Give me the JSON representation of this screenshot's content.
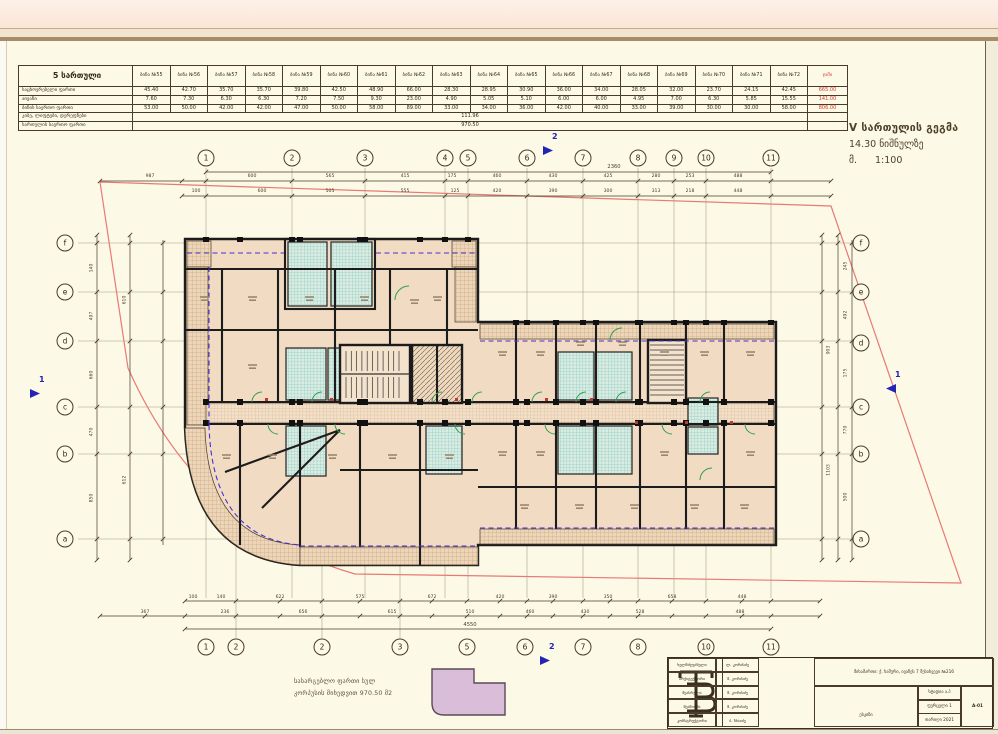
{
  "area_table": {
    "title": "5 სართული",
    "columns": [
      "ბინა №55",
      "ბინა №56",
      "ბინა №57",
      "ბინა №58",
      "ბინა №59",
      "ბინა №60",
      "ბინა №61",
      "ბინა №62",
      "ბინა №63",
      "ბინა №64",
      "ბინა №65",
      "ბინა №66",
      "ბინა №67",
      "ბინა №68",
      "ბინა №69",
      "ბინა №70",
      "ბინა №71",
      "ბინა №72"
    ],
    "total_header": "ჯამი",
    "rows": [
      {
        "label": "საცხოვრებელი ფართი",
        "values": [
          "45.40",
          "42.70",
          "35.70",
          "35.70",
          "39.80",
          "42.50",
          "48.90",
          "66.00",
          "28.30",
          "28.95",
          "30.90",
          "36.00",
          "34.00",
          "28.05",
          "32.00",
          "23.70",
          "24.15",
          "42.45"
        ],
        "total": "665.00"
      },
      {
        "label": "აივანი",
        "values": [
          "7.60",
          "7.30",
          "6.30",
          "6.30",
          "7.20",
          "7.50",
          "9.30",
          "23.00",
          "4.90",
          "5.05",
          "5.10",
          "6.00",
          "6.00",
          "4.95",
          "7.00",
          "6.30",
          "5.85",
          "15.55"
        ],
        "total": "141.00"
      },
      {
        "label": "ბინის საერთო ფართი",
        "values": [
          "53.00",
          "50.00",
          "42.00",
          "42.00",
          "47.00",
          "50.00",
          "58.00",
          "89.00",
          "33.00",
          "34.00",
          "36.00",
          "42.00",
          "40.00",
          "33.00",
          "39.00",
          "30.00",
          "30.00",
          "58.00"
        ],
        "total": "806.00"
      },
      {
        "label": "კიბე, ლიფტები, დერეფნები",
        "span_value": "111.96"
      },
      {
        "label": "სართულის საერთო ფართი",
        "span_value": "970.50"
      }
    ]
  },
  "drawing_title": {
    "line1": "V სართულის გეგმა",
    "line2": "14.30 ნიშნულზე",
    "scale_prefix": "მ.",
    "scale_value": "1:100"
  },
  "legend": {
    "line1": "სასარგებლო ფართი სულ",
    "line2": "კორპუსის მიხედვით 970.50 მ2"
  },
  "grid": {
    "top": [
      {
        "n": "1",
        "x": 206
      },
      {
        "n": "2",
        "x": 292
      },
      {
        "n": "3",
        "x": 365
      },
      {
        "n": "4",
        "x": 445
      },
      {
        "n": "5",
        "x": 468
      },
      {
        "n": "6",
        "x": 527
      },
      {
        "n": "7",
        "x": 583
      },
      {
        "n": "8",
        "x": 638
      },
      {
        "n": "9",
        "x": 674
      },
      {
        "n": "10",
        "x": 706
      },
      {
        "n": "11",
        "x": 771
      }
    ],
    "bottom": [
      {
        "n": "1",
        "x": 206
      },
      {
        "n": "2",
        "x": 236
      },
      {
        "n": "2",
        "x": 322
      },
      {
        "n": "3",
        "x": 400
      },
      {
        "n": "5",
        "x": 467
      },
      {
        "n": "6",
        "x": 525
      },
      {
        "n": "7",
        "x": 583
      },
      {
        "n": "8",
        "x": 638
      },
      {
        "n": "10",
        "x": 706
      },
      {
        "n": "11",
        "x": 771
      }
    ],
    "left": [
      {
        "n": "f",
        "y": 243
      },
      {
        "n": "e",
        "y": 292
      },
      {
        "n": "d",
        "y": 341
      },
      {
        "n": "c",
        "y": 407
      },
      {
        "n": "b",
        "y": 454
      },
      {
        "n": "a",
        "y": 539
      }
    ],
    "right": [
      {
        "n": "f",
        "y": 243
      },
      {
        "n": "e",
        "y": 292
      },
      {
        "n": "d",
        "y": 343
      },
      {
        "n": "c",
        "y": 407
      },
      {
        "n": "b",
        "y": 454
      },
      {
        "n": "a",
        "y": 539
      }
    ]
  },
  "section_markers": [
    {
      "label": "1",
      "x": 30,
      "y": 389,
      "dir": "right"
    },
    {
      "label": "1",
      "x": 886,
      "y": 384,
      "dir": "left"
    },
    {
      "label": "2",
      "x": 543,
      "y": 146,
      "dir": "right"
    },
    {
      "label": "2",
      "x": 540,
      "y": 656,
      "dir": "right"
    }
  ],
  "dimensions": {
    "top_overall": {
      "x": 614,
      "y": 170,
      "v": "2360"
    },
    "top_row1_y": 179,
    "top_row1": [
      {
        "x": 150,
        "v": "987"
      },
      {
        "x": 252,
        "v": "600"
      },
      {
        "x": 330,
        "v": "565"
      },
      {
        "x": 405,
        "v": "415"
      },
      {
        "x": 452,
        "v": "175"
      },
      {
        "x": 497,
        "v": "460"
      },
      {
        "x": 553,
        "v": "430"
      },
      {
        "x": 608,
        "v": "425"
      },
      {
        "x": 656,
        "v": "280"
      },
      {
        "x": 690,
        "v": "253"
      },
      {
        "x": 738,
        "v": "488"
      }
    ],
    "top_row2_y": 194,
    "top_row2": [
      {
        "x": 196,
        "v": "100"
      },
      {
        "x": 262,
        "v": "600"
      },
      {
        "x": 330,
        "v": "505"
      },
      {
        "x": 405,
        "v": "555"
      },
      {
        "x": 455,
        "v": "125"
      },
      {
        "x": 497,
        "v": "420"
      },
      {
        "x": 553,
        "v": "390"
      },
      {
        "x": 608,
        "v": "300"
      },
      {
        "x": 656,
        "v": "313"
      },
      {
        "x": 690,
        "v": "218"
      },
      {
        "x": 738,
        "v": "448"
      }
    ],
    "bottom_row1_y": 600,
    "bottom_row1": [
      {
        "x": 193,
        "v": "100"
      },
      {
        "x": 221,
        "v": "140"
      },
      {
        "x": 280,
        "v": "622"
      },
      {
        "x": 360,
        "v": "575"
      },
      {
        "x": 432,
        "v": "672"
      },
      {
        "x": 500,
        "v": "420"
      },
      {
        "x": 553,
        "v": "390"
      },
      {
        "x": 608,
        "v": "350"
      },
      {
        "x": 672,
        "v": "658"
      },
      {
        "x": 742,
        "v": "448"
      }
    ],
    "bottom_row2_y": 615,
    "bottom_row2": [
      {
        "x": 145,
        "v": "367"
      },
      {
        "x": 225,
        "v": "236"
      },
      {
        "x": 303,
        "v": "656"
      },
      {
        "x": 392,
        "v": "615"
      },
      {
        "x": 470,
        "v": "510"
      },
      {
        "x": 530,
        "v": "460"
      },
      {
        "x": 585,
        "v": "430"
      },
      {
        "x": 640,
        "v": "528"
      },
      {
        "x": 740,
        "v": "488"
      }
    ],
    "bottom_overall": {
      "x": 470,
      "y": 628,
      "v": "4550"
    },
    "left": [
      {
        "x": 92,
        "y": 268,
        "v": "140"
      },
      {
        "x": 92,
        "y": 316,
        "v": "497"
      },
      {
        "x": 92,
        "y": 375,
        "v": "660"
      },
      {
        "x": 92,
        "y": 432,
        "v": "470"
      },
      {
        "x": 92,
        "y": 498,
        "v": "850"
      },
      {
        "x": 125,
        "y": 300,
        "v": "610"
      },
      {
        "x": 125,
        "y": 480,
        "v": "612"
      }
    ],
    "right": [
      {
        "x": 846,
        "y": 266,
        "v": "245"
      },
      {
        "x": 846,
        "y": 315,
        "v": "492"
      },
      {
        "x": 846,
        "y": 373,
        "v": "175"
      },
      {
        "x": 846,
        "y": 430,
        "v": "770"
      },
      {
        "x": 846,
        "y": 497,
        "v": "500"
      },
      {
        "x": 829,
        "y": 350,
        "v": "903"
      },
      {
        "x": 829,
        "y": 470,
        "v": "1103"
      }
    ]
  },
  "title_block": {
    "logo": "TB",
    "entries": [
      {
        "role": "ხელმძღვანელი",
        "name": "ლ. კორძაძე"
      },
      {
        "role": "არქიტექტორი",
        "name": "მ. კორძაძე"
      },
      {
        "role": "შეასრულა",
        "name": "მ. კორძაძე"
      },
      {
        "role": "შეამოწმა",
        "name": "მ. კორძაძე"
      },
      {
        "role": "კონსტრუქტორი",
        "name": "ბ. ჩხაიძე"
      }
    ],
    "project": "მისამართი: ქ. ხაშური, ივანეს 7 შესახვევი №216",
    "drawing_name": "ესკიზი",
    "stage_label": "სტადია ა.პ",
    "sheet_label": "ფურცელი 1",
    "date_label": "თარიღი 2021",
    "sheet_number": "A-01"
  }
}
